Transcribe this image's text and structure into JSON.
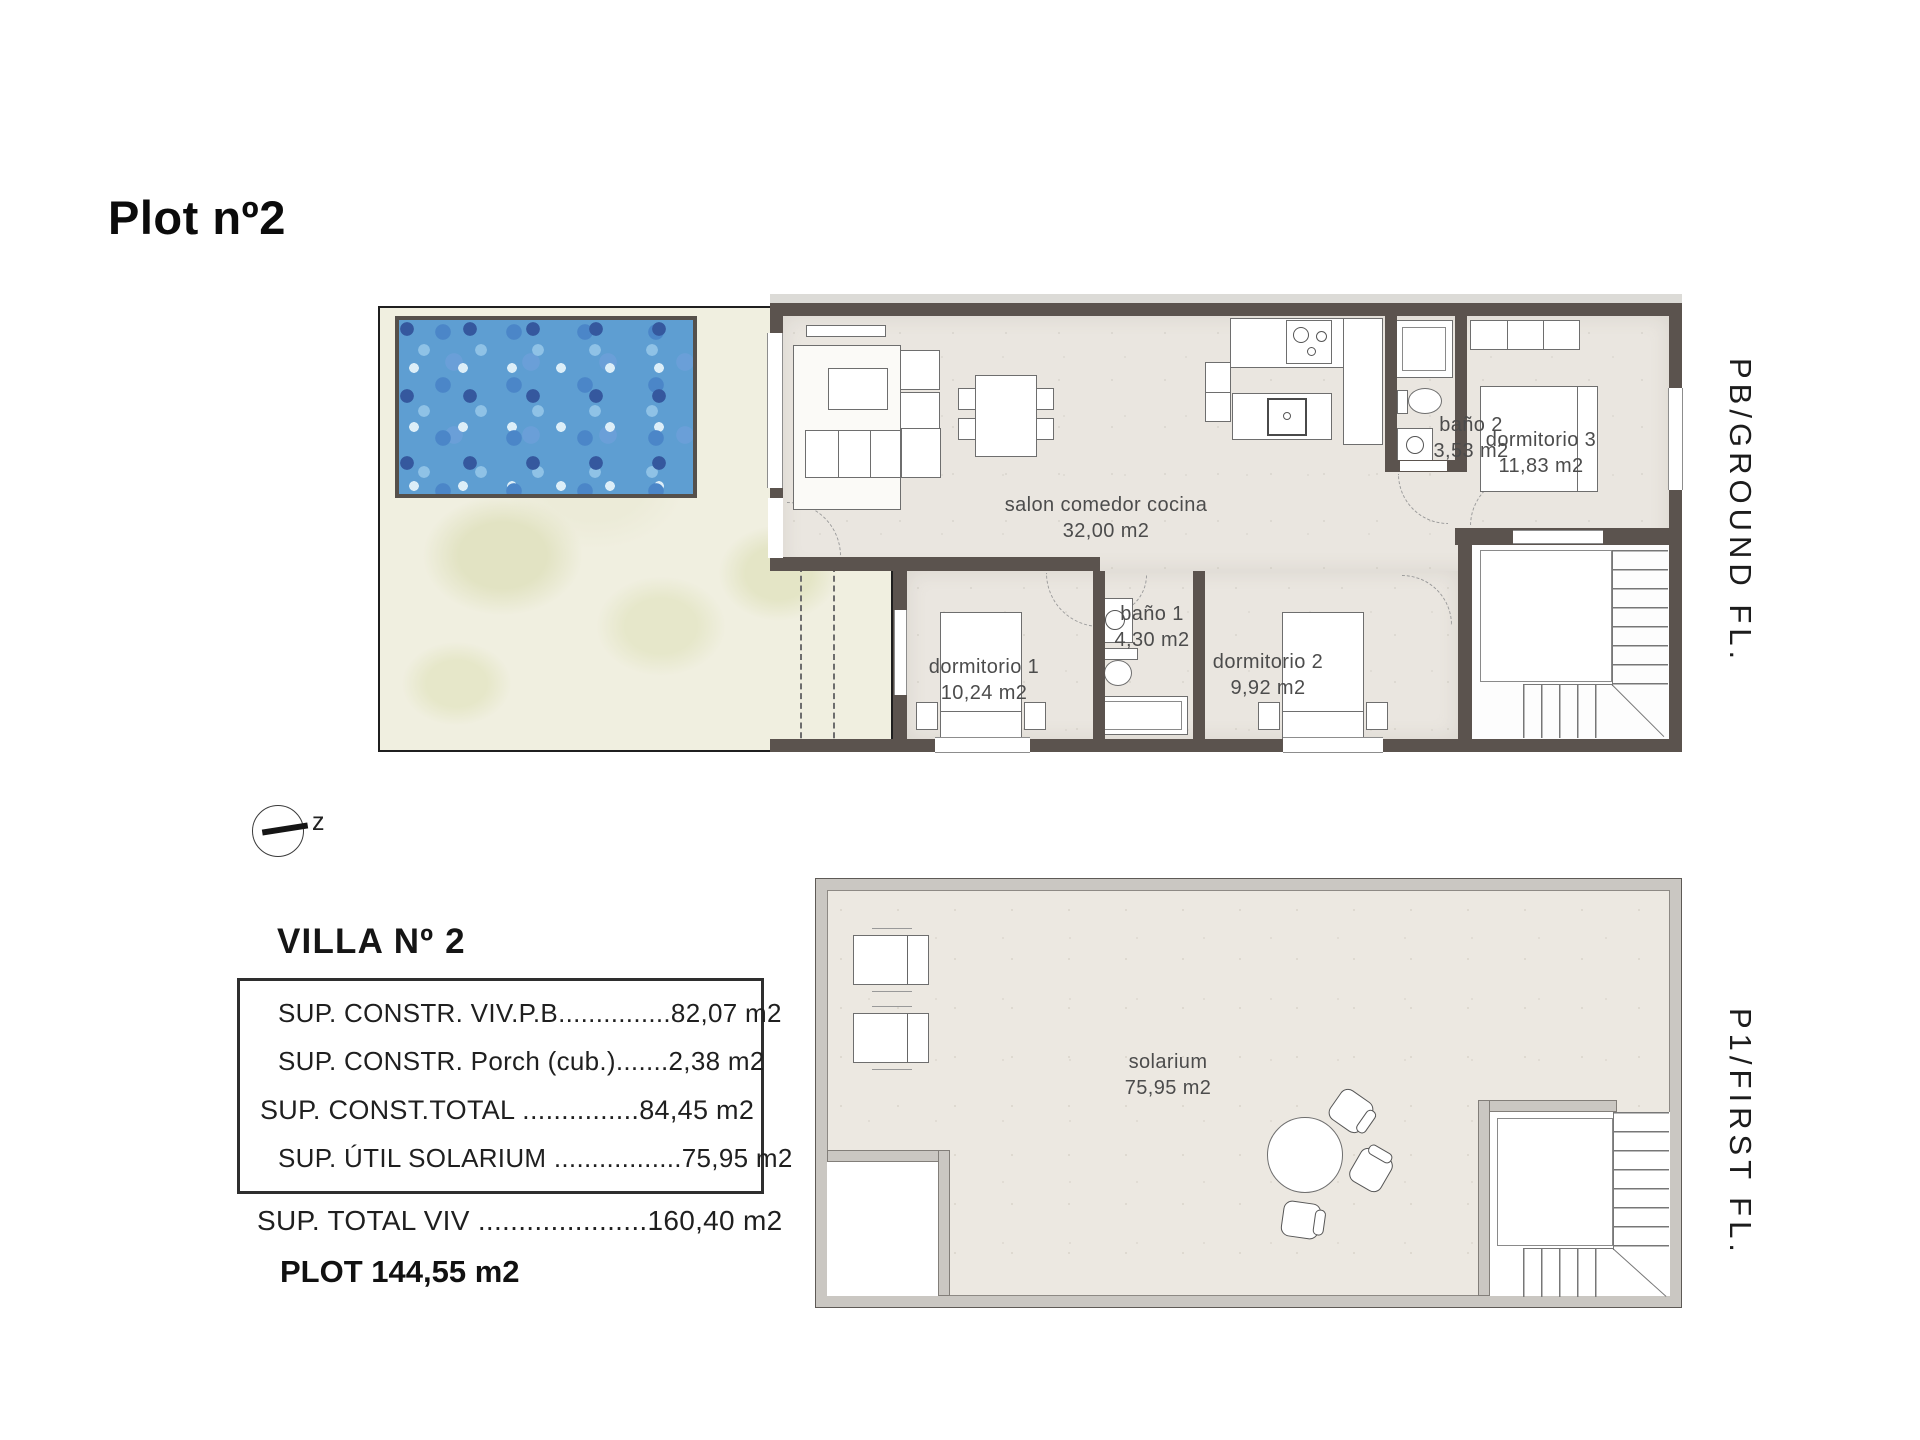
{
  "title": "Plot nº2",
  "compass_label": "z",
  "ground_floor": {
    "side_label": "PB/GROUND FL.",
    "rooms": [
      {
        "name": "salon comedor cocina",
        "area": "32,00 m2"
      },
      {
        "name": "baño 2",
        "area": "3,53 m2"
      },
      {
        "name": "dormitorio 3",
        "area": "11,83 m2"
      },
      {
        "name": "dormitorio 1",
        "area": "10,24 m2"
      },
      {
        "name": "baño 1",
        "area": "4,30 m2"
      },
      {
        "name": "dormitorio 2",
        "area": "9,92 m2"
      }
    ]
  },
  "first_floor": {
    "side_label": "P1/FIRST FL.",
    "rooms": [
      {
        "name": "solarium",
        "area": "75,95 m2"
      }
    ]
  },
  "summary": {
    "heading": "VILLA Nº 2",
    "box_rows": [
      "SUP. CONSTR. VIV.P.B...............82,07 m2",
      "SUP. CONSTR. Porch (cub.).......2,38 m2",
      "SUP. CONST.TOTAL ...............84,45 m2",
      "SUP. ÚTIL SOLARIUM .................75,95 m2"
    ],
    "total_row": "SUP. TOTAL VIV .....................160,40 m2",
    "plot_row": "PLOT 144,55 m2"
  },
  "colors": {
    "wall": "#5b534e",
    "floor": "#eae6e0",
    "garden": "#f0efe0",
    "pool_base": "#5e9ed2",
    "parapet": "#cac7c2"
  }
}
